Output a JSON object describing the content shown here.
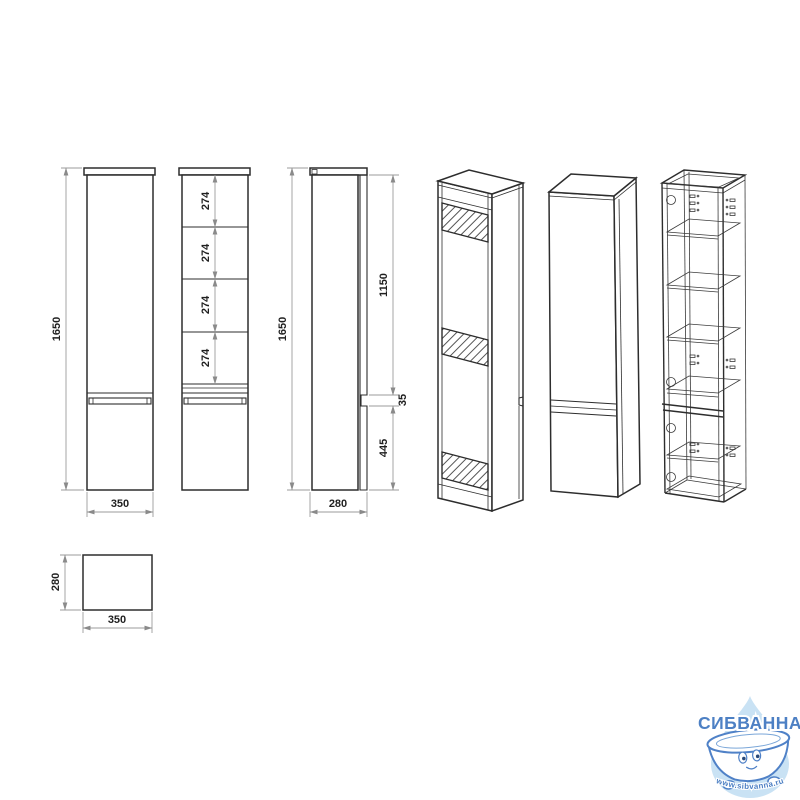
{
  "drawing": {
    "object_line_color": "#2d2d2d",
    "dimension_line_color": "#9b9b9b",
    "label_color": "#1f1f1f",
    "background": "#ffffff",
    "dimensions": {
      "front_height": "1650",
      "front_width": "350",
      "shelf_spacings": [
        "274",
        "274",
        "274",
        "274"
      ],
      "side_height": "1650",
      "side_depth": "280",
      "upper_door_height": "1150",
      "handle_gap": "35",
      "lower_door_height": "445",
      "top_view_width": "350",
      "top_view_depth": "280"
    }
  },
  "logo": {
    "brand": "СИБВАННА",
    "website": "www.sibvanna.ru",
    "brand_color": "#4d80c4",
    "drop_color": "#c9e2f4"
  }
}
